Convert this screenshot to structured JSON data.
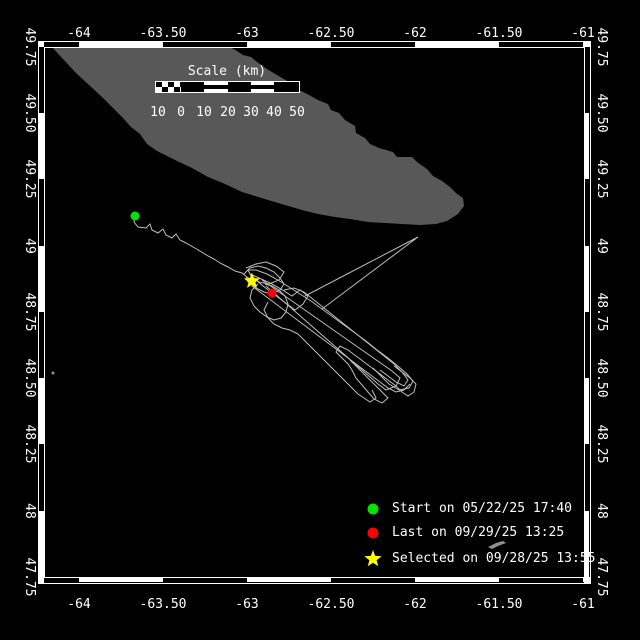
{
  "colors": {
    "background": "#000000",
    "frame": "#ffffff",
    "land": "#585858",
    "track": "#bebebe",
    "start_marker": "#00e400",
    "last_marker": "#ff0000",
    "selected_marker": "#ffff00",
    "annotation_gray": "#909090"
  },
  "axes": {
    "x_labels": [
      "-64",
      "-63.50",
      "-63",
      "-62.50",
      "-62",
      "-61.50",
      "-61"
    ],
    "x_positions": [
      79,
      163,
      247,
      331,
      415,
      499,
      583
    ],
    "y_labels": [
      "49.75",
      "49.50",
      "49.25",
      "49",
      "48.75",
      "48.50",
      "48.25",
      "48",
      "47.75"
    ],
    "y_positions": [
      47,
      113,
      179,
      246,
      312,
      378,
      444,
      511,
      577
    ],
    "top_label_baseline": 37,
    "bottom_label_baseline": 608,
    "left_label_x": 30,
    "right_label_x": 602
  },
  "frame": {
    "outer": [
      38,
      41,
      590,
      583
    ],
    "inner": [
      44,
      47,
      584,
      577
    ],
    "x_bounds": [
      38,
      79,
      163,
      247,
      331,
      415,
      499,
      583,
      590
    ],
    "y_bounds": [
      47,
      113,
      179,
      246,
      312,
      378,
      444,
      511,
      577
    ]
  },
  "scalebar": {
    "title": "Scale (km)",
    "title_cx": 227,
    "title_y": 64,
    "bar": {
      "x": 155,
      "y": 81,
      "w": 143,
      "h": 12
    },
    "segments": [
      {
        "style": "checker",
        "w": 25
      },
      {
        "style": "black",
        "w": 23
      },
      {
        "style": "striped",
        "w": 24
      },
      {
        "style": "black",
        "w": 23
      },
      {
        "style": "striped",
        "w": 23
      },
      {
        "style": "black",
        "w": 23
      }
    ],
    "numbers": [
      "10",
      "0",
      "10",
      "20",
      "30",
      "40",
      "50"
    ],
    "number_x": [
      158,
      181,
      204,
      228,
      251,
      274,
      297
    ],
    "number_y": 105
  },
  "legend": {
    "marker_cx": 373,
    "text_x": 392,
    "items": [
      {
        "marker": "circle",
        "color": "#00e400",
        "label": "Start on 05/22/25 17:40",
        "cy": 509
      },
      {
        "marker": "circle",
        "color": "#ff0000",
        "label": "Last on 09/29/25 13:25",
        "cy": 533
      },
      {
        "marker": "star",
        "color": "#ffff00",
        "label": "Selected on 09/28/25 13:55",
        "cy": 559
      }
    ]
  },
  "map": {
    "island_points": "52,47 230,47 237,51 243,55 251,57 257,62 267,69 277,75 289,82 297,89 309,95 318,100 328,104 331,110 339,113 345,120 355,126 356,133 365,138 370,144 379,148 393,152 397,157 412,157 417,162 427,169 433,176 442,181 450,187 456,193 463,198 464,206 458,214 447,221 436,224 420,225 402,224 385,223 368,222 350,219 335,217 318,214 302,210 285,205 268,200 255,196 242,192 225,184 208,177 192,168 175,160 165,155 157,151 147,144 140,134 131,127 123,118 113,108 101,96 89,85 76,73 63,59",
    "tracks": [
      "135,216 134,222 138,227 146,228 150,224 152,230 158,233 163,229 166,235 172,238 176,234 180,240 186,243 193,247 200,251 208,256 214,259 220,263 228,267 235,271 242,273 247,277 252,280",
      "246,268 256,264 266,262 276,266 284,272 279,280 269,284 259,282 251,276 248,270 256,270 267,274 278,280 289,287 300,294 311,301 322,309 333,317 344,325 355,333 366,341 377,350 388,358 399,367 407,374 413,381 409,388 399,390 389,384 381,376 373,368",
      "250,274 259,278 270,283 281,289 292,296 300,290 308,296 303,304 295,310 287,304 279,298 271,292 263,286 256,280 252,286 260,292 268,298 276,304 284,310 292,316 300,322 308,328 316,334 324,340 332,346 340,352 348,358 356,364 364,370 372,376 380,382 388,388 396,392 404,390 410,384",
      "258,284 252,290 250,298 254,306 260,312 267,317 274,320 281,318 286,312 288,304 285,296 279,290 272,286 265,284",
      "262,280 272,287 282,294 292,301 302,308 312,315 322,322 332,329 342,336 352,343 362,350 372,357 382,364 392,371 400,378 396,386 386,390 378,384 370,377 362,370 354,363 346,356 338,349 330,342 322,335 314,328 306,321 298,314 290,307 282,300 274,293 266,286",
      "305,296 418,237 322,309",
      "244,274 250,268 258,266 266,268 274,272 280,278 284,284 280,290 272,294 264,292 256,288 248,282 246,276",
      "284,290 294,288 304,292 314,300 324,308 334,316 344,324 354,332 364,340 374,348 384,356 394,364 402,372 408,380 404,386 396,382 388,376 380,370",
      "350,360 358,368 366,376 374,384 382,392 388,398 382,403 374,399 368,392 362,385 356,378 352,370 348,364 342,358 336,352 340,346 348,350 356,356 364,362 372,368 380,374 388,380 396,386 402,392 408,396 414,392 416,384 410,378 402,372 394,366",
      "268,302 264,310 268,318 274,324 282,328 290,330 298,334 304,340 310,346 316,352 322,358 328,364 334,370 340,376 346,382 352,388 358,394 364,398 370,402 376,398 372,390"
    ],
    "markers": {
      "start": {
        "x": 135,
        "y": 216,
        "r": 4.5
      },
      "last": {
        "x": 272,
        "y": 293,
        "r": 4.5
      },
      "selected": {
        "x": 252,
        "y": 281,
        "r": 8.5
      }
    },
    "extras": {
      "plane_points": "488,547 496,543 503,541 506,543 498,546 492,549",
      "speck": {
        "x": 53,
        "y": 373,
        "r": 1.5
      }
    }
  }
}
